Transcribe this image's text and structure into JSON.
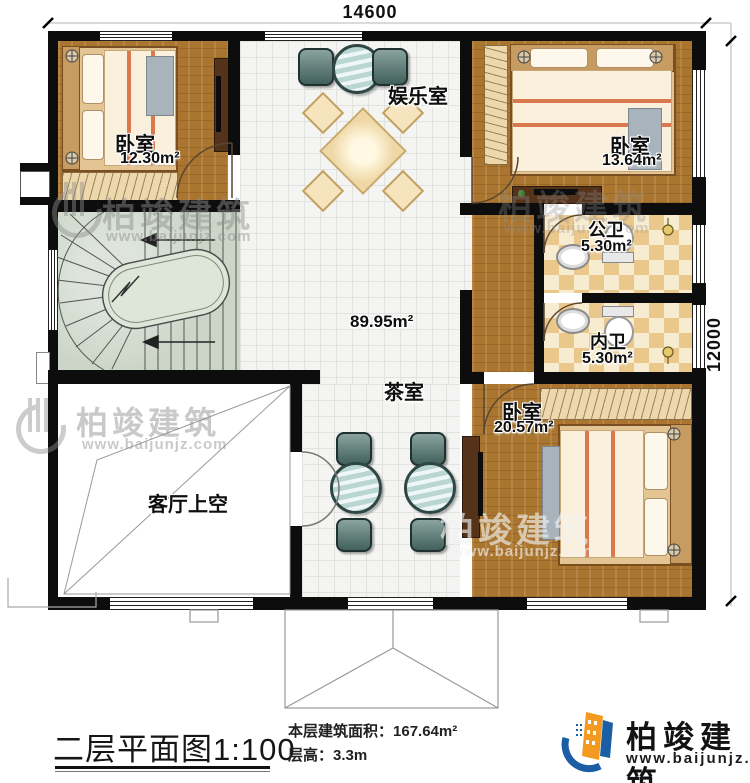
{
  "dimensions": {
    "width_top": "14600",
    "height_right": "12000"
  },
  "rooms": {
    "bedroom_top_left": {
      "name": "卧室",
      "area": "12.30m²"
    },
    "bedroom_top_right": {
      "name": "卧室",
      "area": "13.64m²"
    },
    "bedroom_bottom_right": {
      "name": "卧室",
      "area": "20.57m²"
    },
    "entertainment_room": {
      "name": "娱乐室"
    },
    "public_bathroom": {
      "name": "公卫",
      "area": "5.30m²"
    },
    "private_bathroom": {
      "name": "内卫",
      "area": "5.30m²"
    },
    "tea_room": {
      "name": "茶室"
    },
    "hall": {
      "area": "89.95m²"
    },
    "living_room_void": {
      "name": "客厅上空"
    }
  },
  "footer": {
    "plan_title": "二层平面图1:100",
    "area_label": "本层建筑面积：",
    "area_value": "167.64m²",
    "height_label": "层高：",
    "height_value": "3.3m"
  },
  "brand": {
    "name": "柏竣建筑",
    "website": "www.baijunjz.com"
  },
  "colors": {
    "wall": "#0d0d0d",
    "wood": "#aa762f",
    "tile": "#f4f4f2",
    "checker_dark": "#eac78b",
    "checker_light": "#f8ecd0",
    "stairs": "#ccd6c8",
    "logo_blue": "#1b5ea6",
    "logo_orange": "#f59a20"
  }
}
